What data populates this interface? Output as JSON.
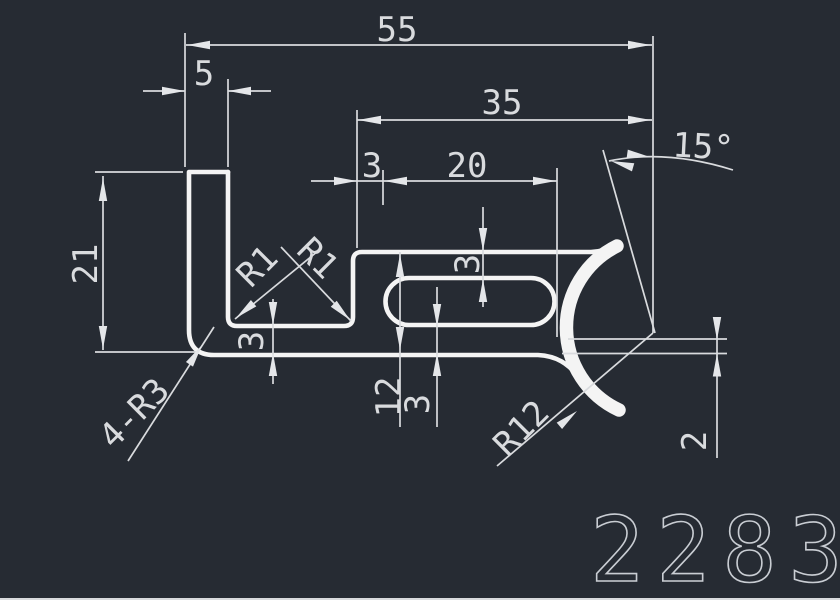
{
  "drawing": {
    "type": "cad-profile-cross-section",
    "part_number": "2283",
    "colors": {
      "background": "#262b33",
      "profile_line": "#f4f4f4",
      "dimension_line": "#d9dbde",
      "dimension_text": "#d9dbde",
      "part_number_stroke": "#c9cdd3"
    },
    "dimensions": {
      "total_width": "55",
      "leg_width": "5",
      "arm_width": "35",
      "slot_offset": "3",
      "slot_length": "20",
      "angle": "15°",
      "leg_height": "21",
      "inner_fillet_left": "R1",
      "inner_fillet_right": "R1",
      "slot_top_wall": "3",
      "base_thickness": "3",
      "arm_height": "12",
      "slot_bottom_wall": "3",
      "corner_fillets": "4-R3",
      "hook_radius": "R12",
      "hook_thickness": "2"
    }
  }
}
